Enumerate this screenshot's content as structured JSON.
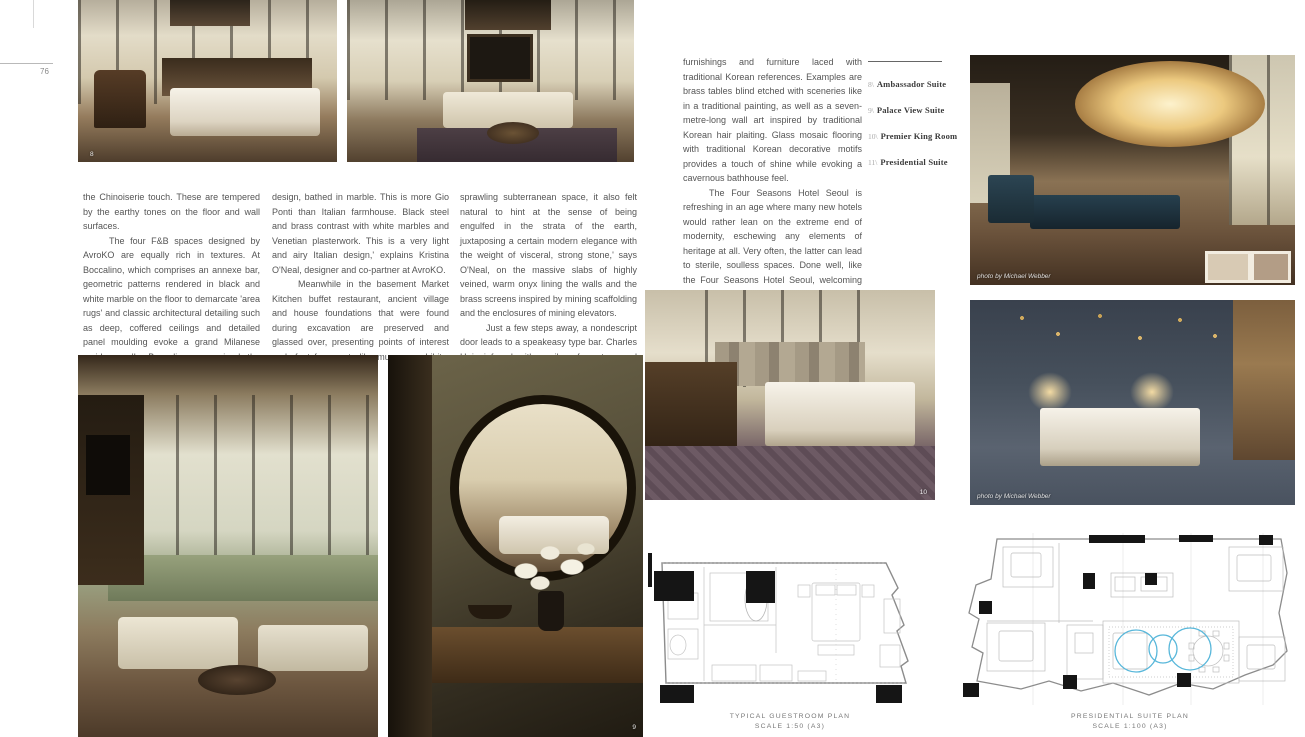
{
  "page": {
    "folio": "76"
  },
  "article": {
    "col1": {
      "p1": "the Chinoiserie touch. These are tempered by the earthy tones on the floor and wall surfaces.",
      "p2": "The four F&B spaces designed by AvroKO are equally rich in textures. At Boccalino, which comprises an annexe bar, geometric patterns rendered in black and white marble on the floor to demarcate 'area rugs' and classic architectural detailing such as deep, coffered ceilings and detailed panel moulding evoke a grand Milanese residence. 'In Boccalino, we mined the artistry and tailored cleanliness of mid-century modern Italian"
    },
    "col2": {
      "p1": "design, bathed in marble. This is more Gio Ponti than Italian farmhouse. Black steel and brass contrast with white marbles and Venetian plasterwork. This is a very light and airy Italian design,' explains Kristina O'Neal, designer and co-partner at AvroKO.",
      "p2": "Meanwhile in the basement Market Kitchen buffet restaurant, ancient village and house foundations that were found during excavation are preserved and glassed over, presenting points of interest underfoot for guests like museum exhibits. 'As we were in a"
    },
    "col3": {
      "p1": "sprawling subterranean space, it also felt natural to hint at the sense of being engulfed in the strata of the earth, juxtaposing a certain modern elegance with the weight of visceral, strong stone,' says O'Neal, on the massive slabs of highly veined, warm onyx lining the walls and the brass screens inspired by mining scaffolding and the enclosures of mining elevators.",
      "p2": "Just a few steps away, a nondescript door leads to a speakeasy type bar. Charles H is infused with a vibe of mystery and sensuality, decorated with custom"
    },
    "col4": {
      "p1": "furnishings and furniture laced with traditional Korean references. Examples are brass tables blind etched with sceneries like in a traditional painting, as well as a seven-metre-long wall art inspired by traditional Korean hair plaiting. Glass mosaic flooring with traditional Korean decorative motifs provides a touch of shine while evoking a cavernous bathhouse feel.",
      "p2": "The Four Seasons Hotel Seoul is refreshing in an age where many new hotels would rather lean on the extreme end of modernity, eschewing any elements of heritage at all. Very often, the latter can lead to sterile, soulless spaces. Done well, like the Four Seasons Hotel Seoul, welcoming and engaging spaces that are more layered with subtle storytelling and textures are created. ✦"
    }
  },
  "captions": {
    "items": [
      {
        "num": "8\\",
        "label": "Ambassador Suite"
      },
      {
        "num": "9\\",
        "label": "Palace View Suite"
      },
      {
        "num": "10\\",
        "label": "Premier King Room"
      },
      {
        "num": "11\\",
        "label": "Presidential Suite"
      }
    ]
  },
  "photos": {
    "ambassador_suite": {
      "number": "8"
    },
    "mirror_vignette": {
      "number": "9"
    },
    "premier_king_room": {
      "number": "10"
    },
    "lounge": {
      "credit": "photo by Michael Webber"
    },
    "palace_view_suite": {
      "credit": "photo by Michael Webber"
    }
  },
  "plans": {
    "guestroom": {
      "title": "TYPICAL GUESTROOM PLAN",
      "scale": "SCALE 1:50 (A3)"
    },
    "presidential": {
      "title": "PRESIDENTIAL SUITE PLAN",
      "scale": "SCALE 1:100 (A3)"
    }
  },
  "colors": {
    "accent_cyan": "#58b7da",
    "plan_line": "#9a9a9a"
  }
}
